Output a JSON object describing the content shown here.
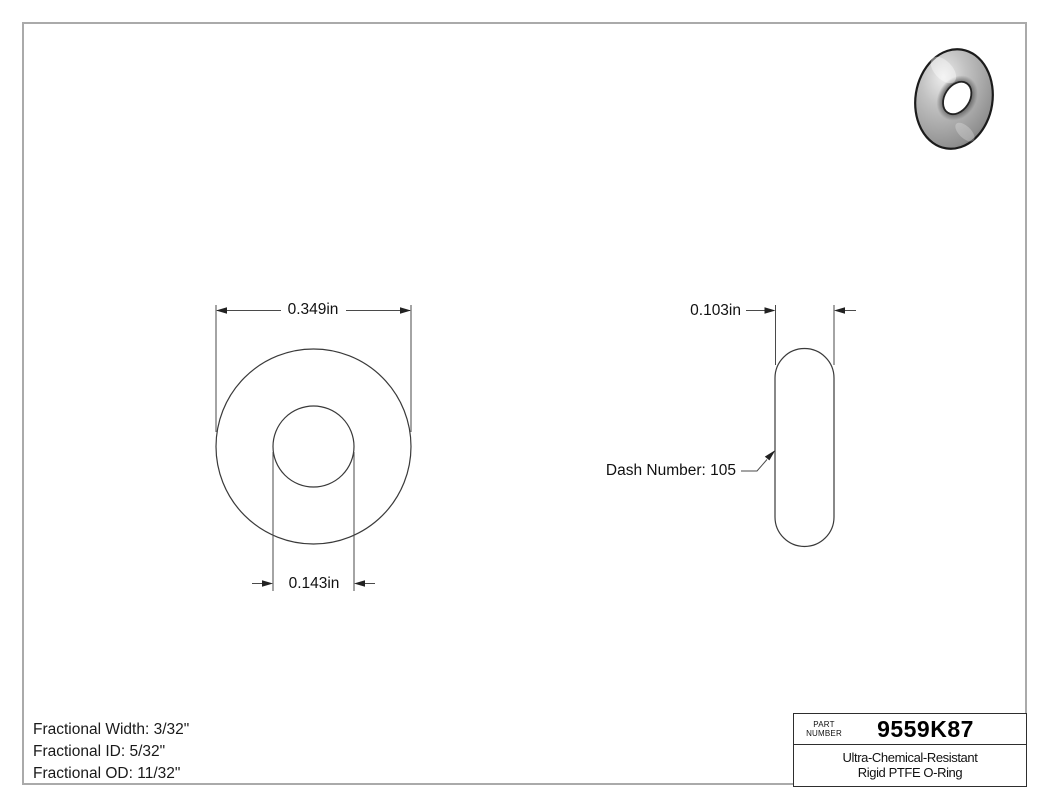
{
  "drawing": {
    "front_view": {
      "od_label": "0.349in",
      "id_label": "0.143in"
    },
    "side_view": {
      "width_label": "0.103in",
      "dash_label": "Dash Number: 105"
    },
    "specs": {
      "line1": "Fractional Width: 3/32\"",
      "line2": "Fractional ID: 5/32\"",
      "line3": "Fractional OD: 11/32\""
    },
    "title_block": {
      "part_word1": "PART",
      "part_word2": "NUMBER",
      "part_number": "9559K87",
      "desc_line1": "Ultra-Chemical-Resistant",
      "desc_line2": "Rigid PTFE O-Ring"
    },
    "colors": {
      "background": "#ffffff",
      "page_border": "#aaaaaa",
      "drawing_line": "#3a3a3a",
      "arrow_fill": "#222222",
      "text": "#111111",
      "title_block_border": "#2e2e2e",
      "render_body_gray": "#a6a6a6"
    }
  }
}
